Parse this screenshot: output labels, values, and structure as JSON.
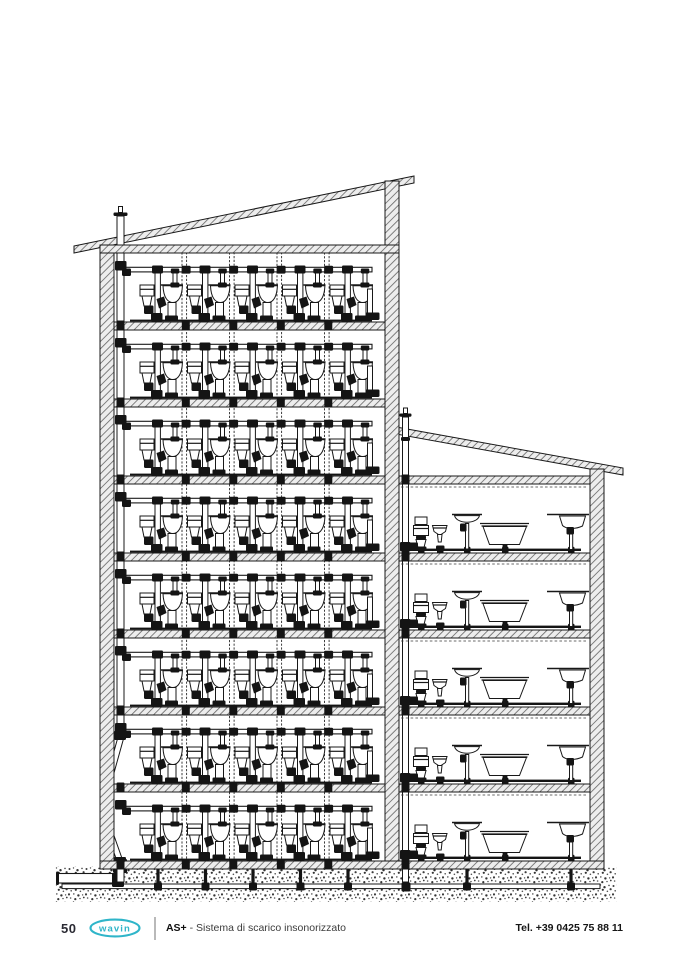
{
  "footer": {
    "page_number": "50",
    "brand_logo_text": "wavin",
    "product_label": "AS+",
    "product_description": "- Sistema di scarico insonorizzato",
    "phone": "Tel. +39 0425 75 88 11"
  },
  "colors": {
    "brand_teal": "#2fb5c9",
    "ink": "#181818"
  },
  "drawing": {
    "type": "building-cross-section",
    "tall_building": {
      "floors": 8,
      "bathroom_units_per_floor": 5,
      "unit_fixtures": [
        "washbasin",
        "toilet"
      ],
      "riser_stacks": 4,
      "main_soil_stack": true,
      "roof_vent": true
    },
    "annex_building": {
      "floors": 5,
      "fixtures_per_floor": [
        "wc-with-cistern",
        "bidet",
        "pedestal-washbasin",
        "bathtub",
        "kitchen-sink"
      ],
      "roof_vent": true
    },
    "ground": {
      "buried_collector_drain": true,
      "external_sewer_connection": true
    }
  }
}
